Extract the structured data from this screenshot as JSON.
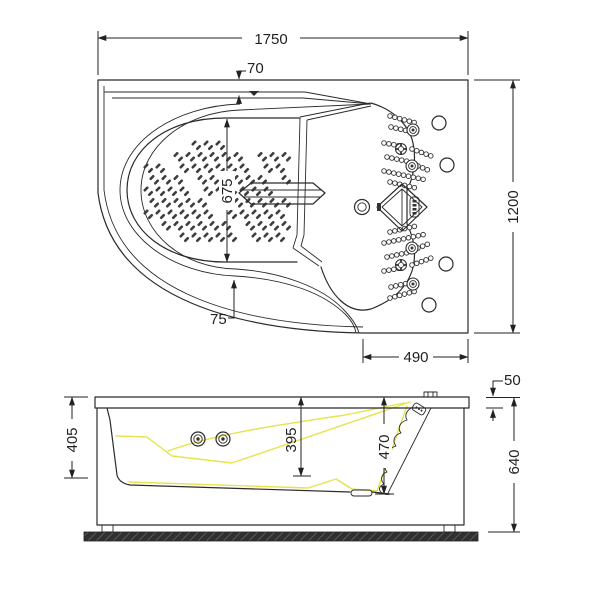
{
  "plan_view": {
    "overall_length": "1750",
    "rim_width": "70",
    "overall_width": "1200",
    "basin_width": "675",
    "apron_gap": "75",
    "seat_section_length": "490"
  },
  "side_view": {
    "rim_height": "405",
    "basin_depth": "395",
    "seat_depth": "470",
    "rim_thickness": "50",
    "overall_height": "640"
  },
  "colors": {
    "line": "#2b2b2b",
    "dimension": "#222222",
    "highlight": "#e6e34e",
    "floor": "#303030"
  }
}
